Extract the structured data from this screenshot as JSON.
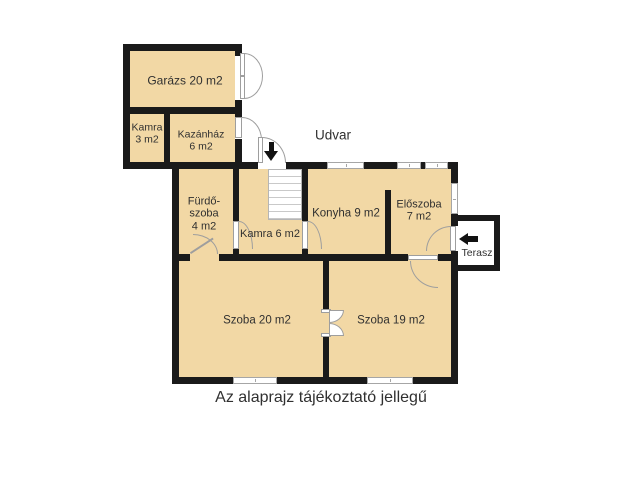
{
  "meta": {
    "caption": "Az alaprajz tájékoztató jellegű"
  },
  "outdoor": {
    "courtyard_label": "Udvar",
    "terrace_label": "Terasz"
  },
  "rooms": {
    "garage": {
      "label": "Garázs 20 m2"
    },
    "pantry_small": {
      "lines": [
        "Kamra",
        "3 m2"
      ]
    },
    "boiler_room": {
      "lines": [
        "Kazánház",
        "6 m2"
      ]
    },
    "bathroom": {
      "lines": [
        "Fürdő-",
        "szoba",
        "4 m2"
      ]
    },
    "pantry_hall": {
      "label": "Kamra 6 m2"
    },
    "kitchen": {
      "label": "Konyha 9 m2"
    },
    "hallway": {
      "lines": [
        "Előszoba",
        "7 m2"
      ]
    },
    "room_20": {
      "label": "Szoba 20 m2"
    },
    "room_19": {
      "label": "Szoba 19 m2"
    }
  },
  "colors": {
    "room-fill": "#F2D8A5",
    "wall": "#1A1A1A",
    "door-line": "#9E9E9E",
    "window-frame": "#A6A6A6",
    "stairs-line": "#C9C9C9",
    "text": "#303030",
    "arrow": "#111111"
  }
}
